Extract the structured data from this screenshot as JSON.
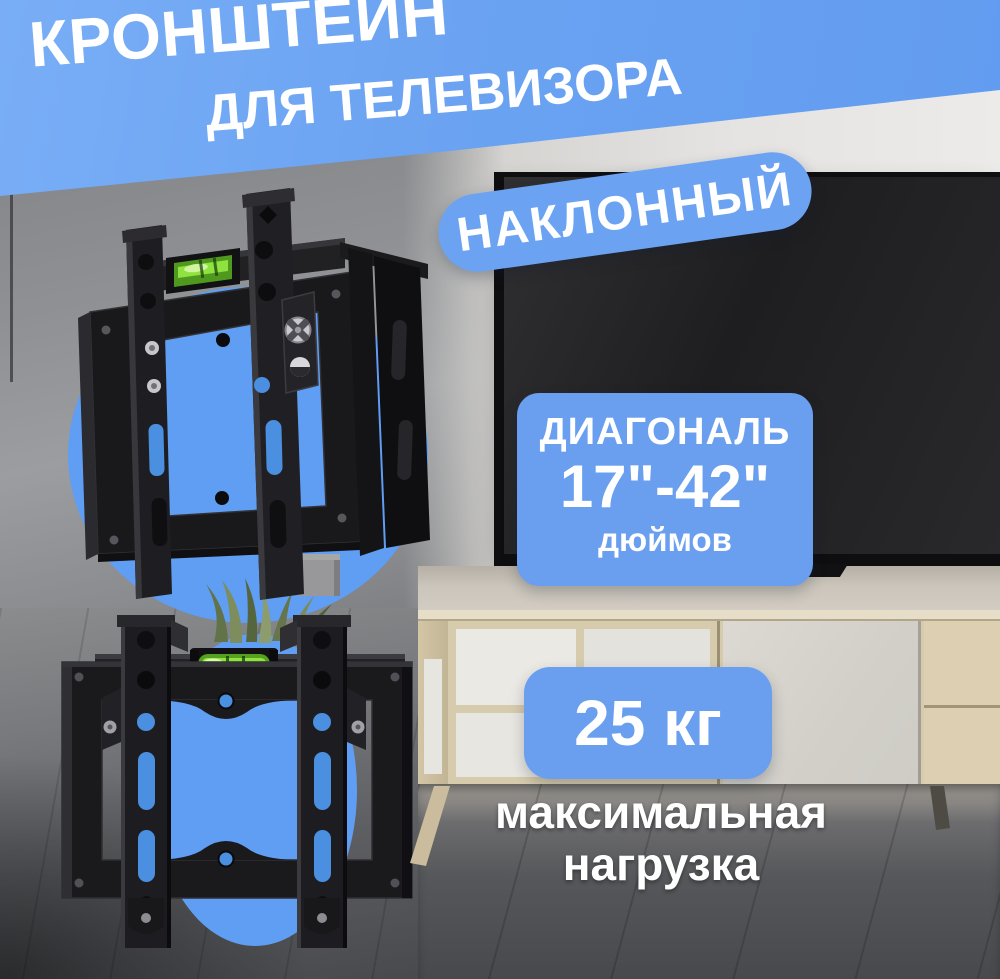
{
  "meta": {
    "kind": "marketplace-product-promo-image",
    "language": "ru"
  },
  "banner": {
    "line1": "КРОНШТЕЙН",
    "line2": "ДЛЯ ТЕЛЕВИЗОРА"
  },
  "badge": {
    "label": "НАКЛОННЫЙ"
  },
  "diagonal_card": {
    "title": "ДИАГОНАЛЬ",
    "range": "17\"-42\"",
    "unit": "дюймов"
  },
  "load_card": {
    "value": "25 кг",
    "caption_line1": "максимальная",
    "caption_line2": "нагрузка"
  },
  "photos": [
    {
      "name": "bracket-three-quarter-view",
      "subject": "black TV wall-mount bracket with green spirit level on blue circle"
    },
    {
      "name": "bracket-front-view",
      "subject": "black TV wall-mount bracket with green spirit level on blue circle"
    }
  ],
  "background": "living room: gray wall, flat TV on wall, wooden TV stand, plant, gray plank floor",
  "colors": {
    "banner_blue": "#6ba3f2",
    "card_blue": "#699fee",
    "circle_blue": "#5f9ef3",
    "level_green": "#8fe23f",
    "metal_dark": "#1a1a1d",
    "wood_light": "#d7cbad",
    "wall_gray": "#8e9093",
    "wall_light": "#e4e3e1",
    "floor_dark": "#56575a",
    "text_white": "#ffffff"
  }
}
